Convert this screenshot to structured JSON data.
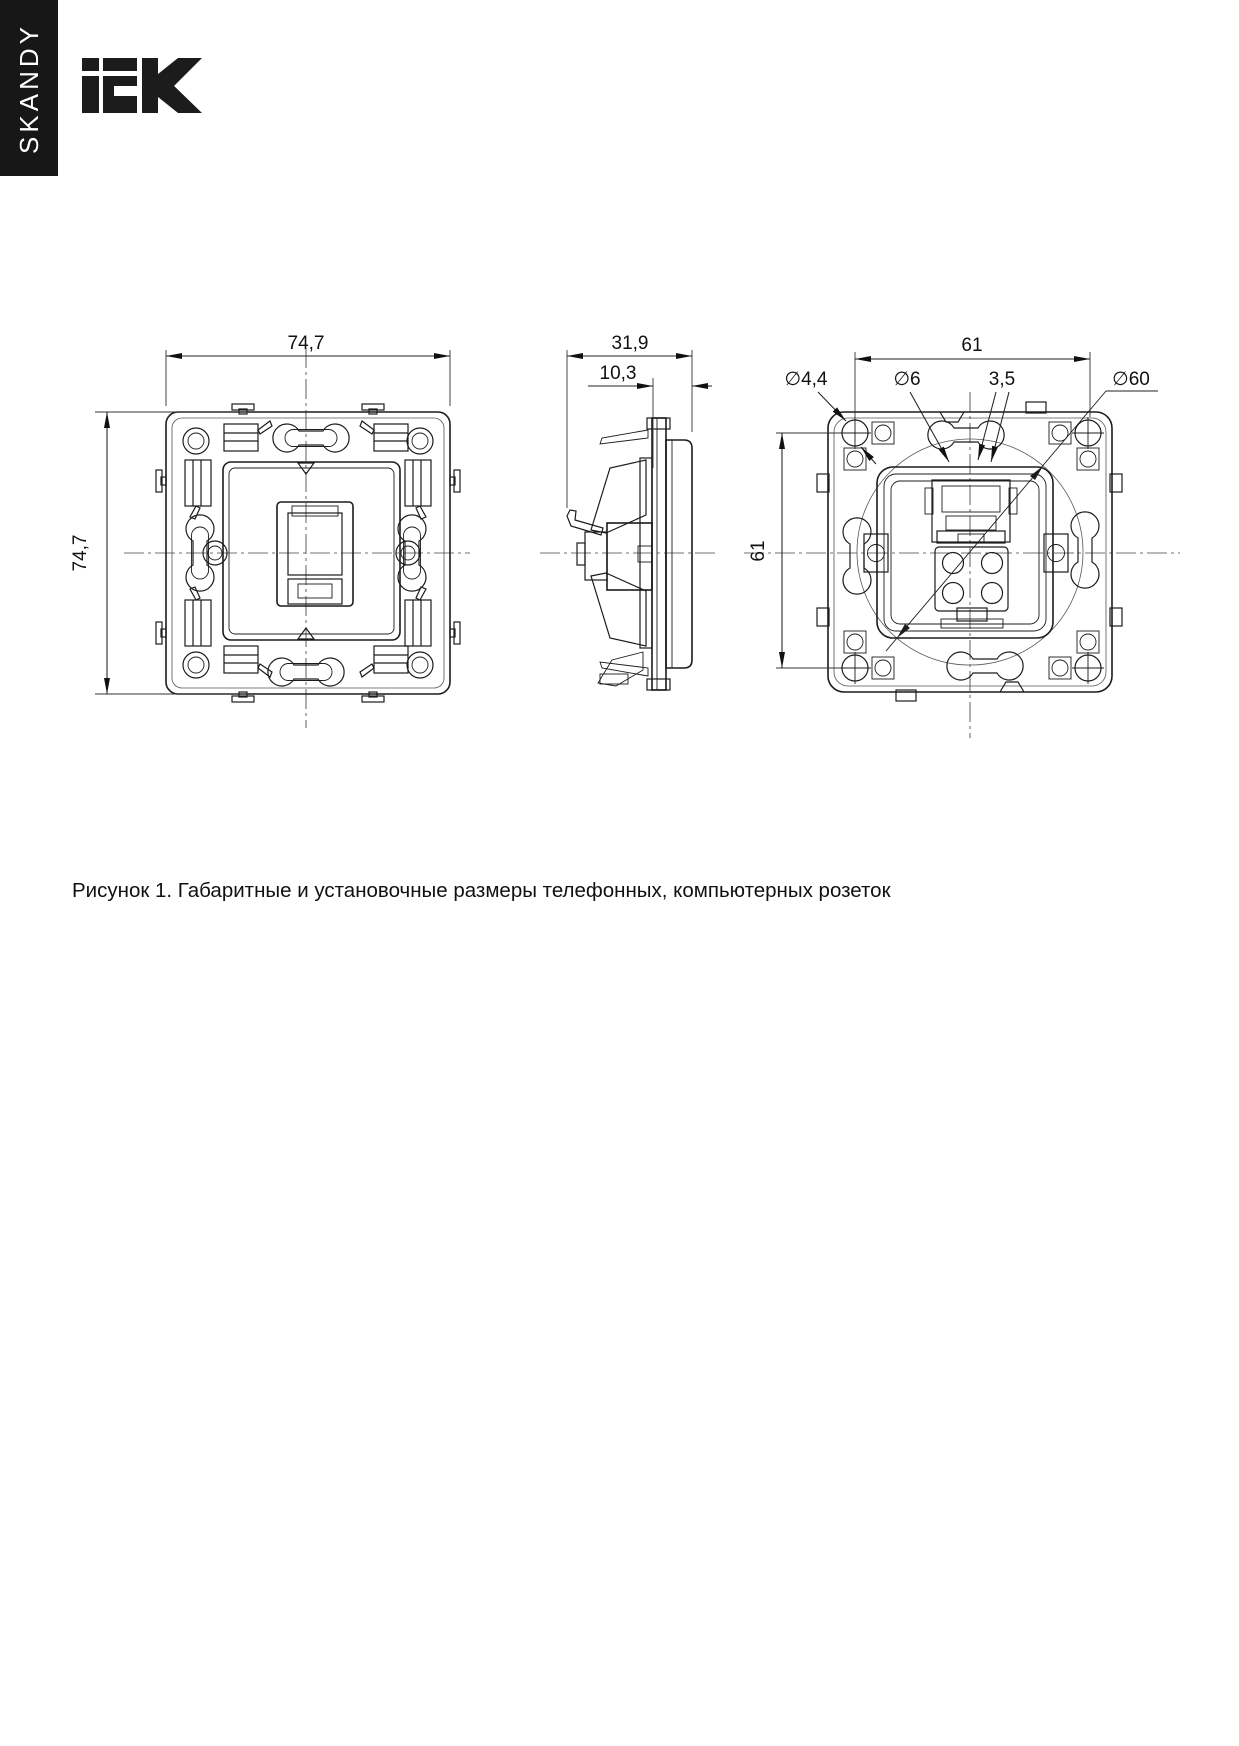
{
  "brand": {
    "series": "SKANDY",
    "logo": "IEK"
  },
  "caption": "Рисунок 1. Габаритные и установочные размеры телефонных, компьютерных розеток",
  "dimensions": {
    "front_width": "74,7",
    "front_height": "74,7",
    "side_depth": "31,9",
    "side_front_depth": "10,3",
    "mount_spacing_h": "61",
    "mount_spacing_v": "61",
    "screw_hole_dia": "∅4,4",
    "hole_dia": "∅6",
    "plate_thickness": "3,5",
    "box_dia": "∅60"
  }
}
